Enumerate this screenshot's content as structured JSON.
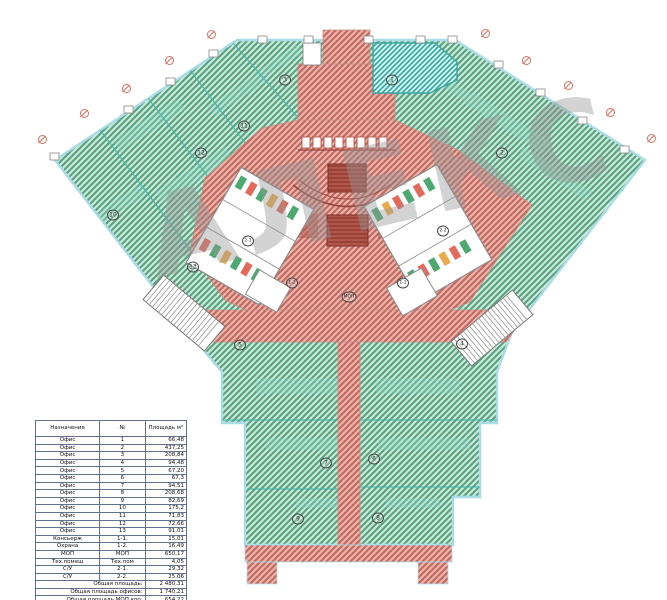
{
  "plan": {
    "watermark_text": "АЛЕКС",
    "room_labels": [
      {
        "text": "1",
        "x": 392,
        "y": 80
      },
      {
        "text": "2",
        "x": 502,
        "y": 153
      },
      {
        "text": "3",
        "x": 285,
        "y": 80
      },
      {
        "text": "11",
        "x": 244,
        "y": 126
      },
      {
        "text": "12",
        "x": 201,
        "y": 153
      },
      {
        "text": "10",
        "x": 113,
        "y": 215
      },
      {
        "text": "13",
        "x": 193,
        "y": 267
      },
      {
        "text": "5",
        "x": 240,
        "y": 345
      },
      {
        "text": "4",
        "x": 462,
        "y": 344
      },
      {
        "text": "7",
        "x": 326,
        "y": 463
      },
      {
        "text": "6",
        "x": 374,
        "y": 459
      },
      {
        "text": "9",
        "x": 298,
        "y": 519
      },
      {
        "text": "8",
        "x": 378,
        "y": 518
      },
      {
        "text": "2-1",
        "x": 248,
        "y": 241
      },
      {
        "text": "2-2",
        "x": 443,
        "y": 231
      },
      {
        "text": "1-2",
        "x": 292,
        "y": 283
      },
      {
        "text": "1-1",
        "x": 403,
        "y": 283
      },
      {
        "text": "МОП",
        "x": 349,
        "y": 297
      }
    ],
    "axis_marks": [
      {
        "x": 42,
        "y": 139
      },
      {
        "x": 84,
        "y": 113
      },
      {
        "x": 126,
        "y": 88
      },
      {
        "x": 169,
        "y": 60
      },
      {
        "x": 211,
        "y": 34
      },
      {
        "x": 485,
        "y": 33
      },
      {
        "x": 526,
        "y": 60
      },
      {
        "x": 568,
        "y": 85
      },
      {
        "x": 610,
        "y": 112
      },
      {
        "x": 651,
        "y": 138
      }
    ],
    "colors": {
      "office_hatch": "#55a383",
      "office_bg": "#cfe9d8",
      "mop_hatch": "#c3685e",
      "mop_bg": "#eab5ac",
      "tech_hatch": "#2fa9a1",
      "glazing_outline": "#aadce8",
      "axis_mark": "#d8604f",
      "stair_tread": "#7c2f28",
      "watermark": "#969696"
    }
  },
  "table": {
    "headers": [
      "Назначение",
      "№",
      "Площадь м²"
    ],
    "rows": [
      [
        "Офис",
        "1",
        "66,48"
      ],
      [
        "Офис",
        "2",
        "437,25"
      ],
      [
        "Офис",
        "3",
        "208,84"
      ],
      [
        "Офис",
        "4",
        "94,48"
      ],
      [
        "Офис",
        "5",
        "67,20"
      ],
      [
        "Офис",
        "6",
        "67,3"
      ],
      [
        "Офис",
        "7",
        "94,51"
      ],
      [
        "Офис",
        "8",
        "208,68"
      ],
      [
        "Офис",
        "9",
        "82,69"
      ],
      [
        "Офис",
        "10",
        "175,2"
      ],
      [
        "Офис",
        "11",
        "71,83"
      ],
      [
        "Офис",
        "12",
        "72,66"
      ],
      [
        "Офис",
        "13",
        "91,01"
      ],
      [
        "Консьерж",
        "1-1.",
        "15,01"
      ],
      [
        "Охрана",
        "1-2.",
        "16,49"
      ],
      [
        "МОП",
        "МОП",
        "650,17"
      ],
      [
        "Тех.помещ",
        "Тех.пом",
        "4,05"
      ],
      [
        "С/У",
        "2-1.",
        "29,32"
      ],
      [
        "С/У",
        "2-2.",
        "25,06"
      ]
    ],
    "totals": [
      [
        "Общая площадь:",
        "2 480,31"
      ],
      [
        "Общая площадь офисов:",
        "1 740,21"
      ],
      [
        "Общая площадь МОП кор:",
        "654,22"
      ],
      [
        "Общая площадь С/У:",
        "54,38"
      ],
      [
        "Комнаты консьержа и охраны:",
        "31,5"
      ]
    ]
  }
}
